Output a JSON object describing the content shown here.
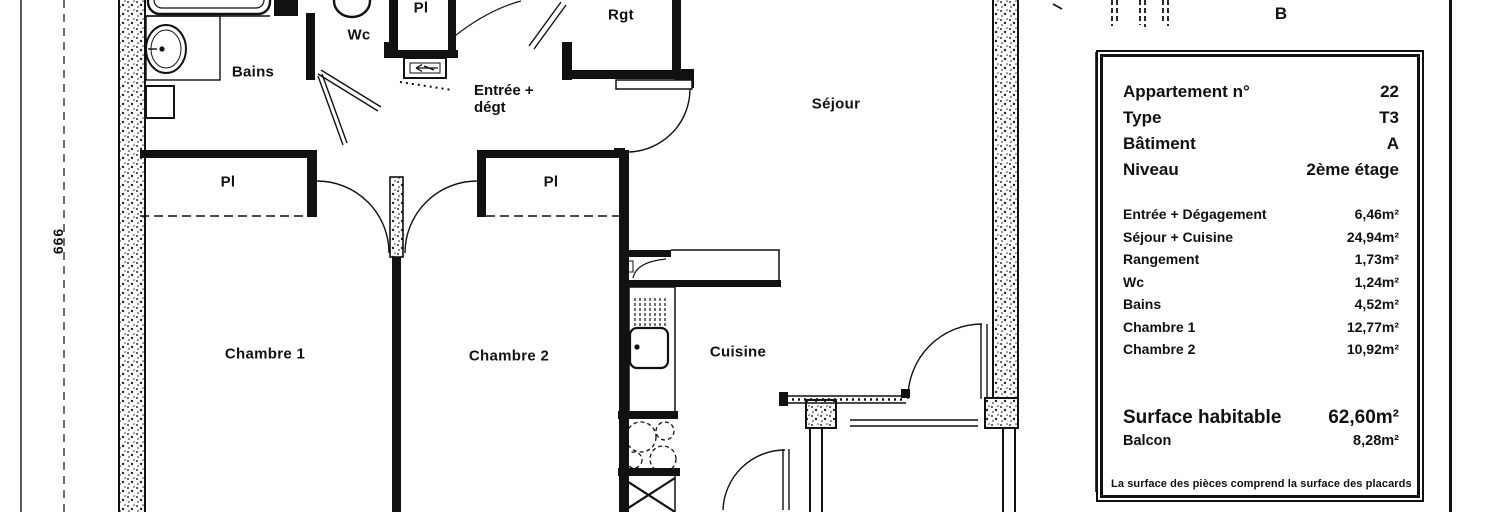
{
  "floor_plan": {
    "dimension_label": "666",
    "building_label": "B",
    "room_labels": {
      "bains": "Bains",
      "wc": "Wc",
      "placard": "Pl",
      "entree_line1": "Entrée +",
      "entree_line2": "dégt",
      "rangement": "Rgt",
      "sejour": "Séjour",
      "chambre1": "Chambre 1",
      "chambre2": "Chambre 2",
      "cuisine": "Cuisine"
    }
  },
  "info_panel": {
    "header_rows": [
      {
        "label": "Appartement n°",
        "value": "22"
      },
      {
        "label": "Type",
        "value": "T3"
      },
      {
        "label": "Bâtiment",
        "value": "A"
      },
      {
        "label": "Niveau",
        "value": "2ème étage"
      }
    ],
    "area_rows": [
      {
        "label": "Entrée + Dégagement",
        "value": "6,46m²"
      },
      {
        "label": "Séjour + Cuisine",
        "value": "24,94m²"
      },
      {
        "label": "Rangement",
        "value": "1,73m²"
      },
      {
        "label": "Wc",
        "value": "1,24m²"
      },
      {
        "label": "Bains",
        "value": "4,52m²"
      },
      {
        "label": "Chambre 1",
        "value": "12,77m²"
      },
      {
        "label": "Chambre 2",
        "value": "10,92m²"
      }
    ],
    "total_rows": [
      {
        "label": "Surface habitable",
        "value": "62,60m²"
      },
      {
        "label": "Balcon",
        "value": "8,28m²"
      }
    ],
    "footnote": "La surface des pièces comprend la surface des placards"
  },
  "colors": {
    "ink": "#111111",
    "paper": "#ffffff"
  }
}
